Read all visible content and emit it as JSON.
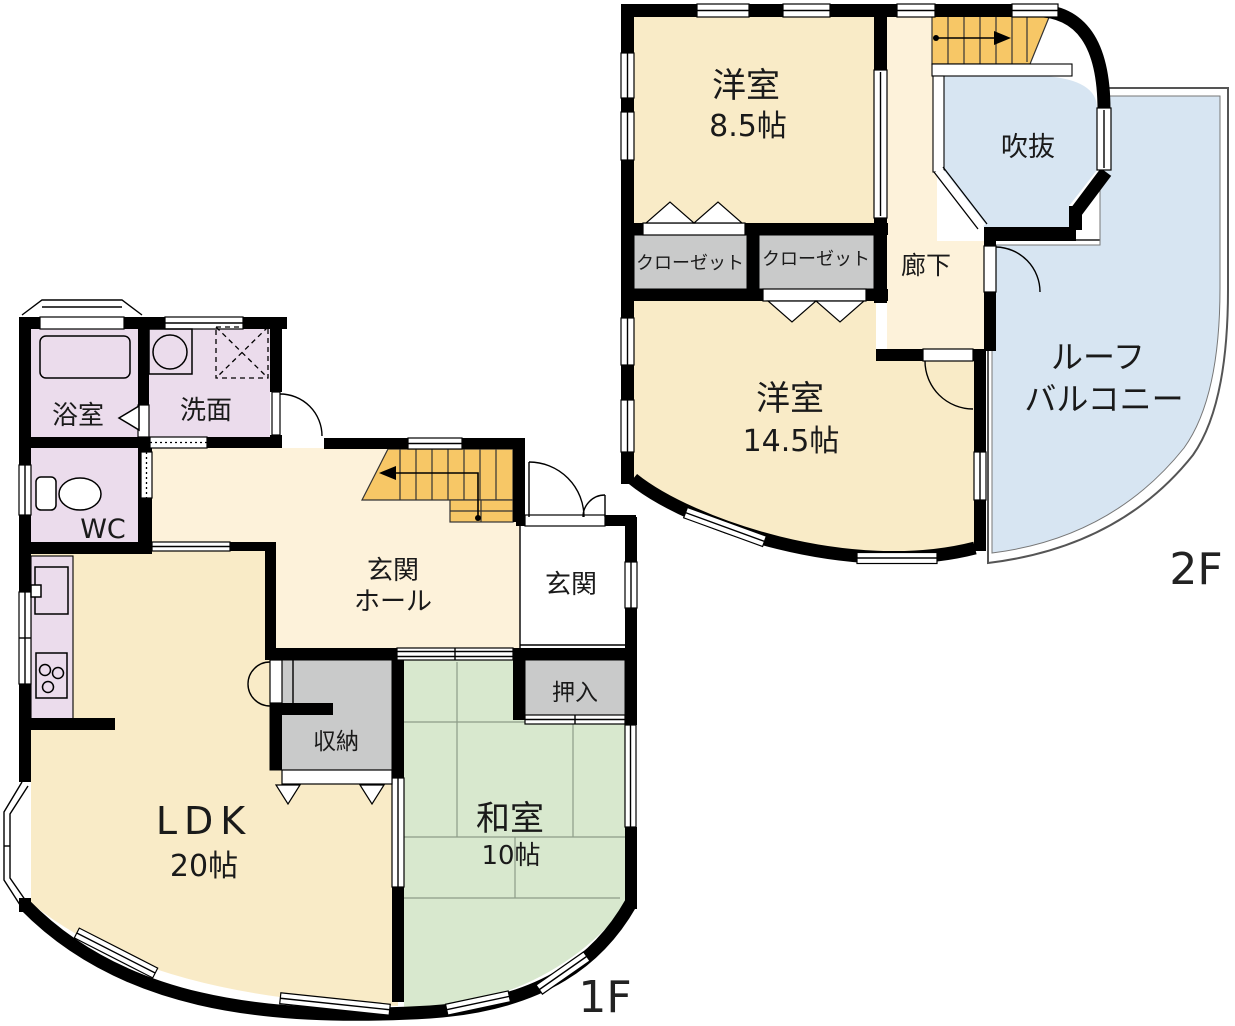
{
  "title": "2-story house floor plan",
  "colors": {
    "room_cream": "#F9EBC7",
    "hall_cream": "#FDF2DA",
    "tatami_green": "#D8E8CE",
    "storage_gray": "#C9CACA",
    "wet_lavender": "#EBDCEC",
    "stairs_orange": "#F7C766",
    "sky_blue": "#D7E5F2",
    "wall_black": "#000000",
    "paper_white": "#FFFFFF"
  },
  "floor2": {
    "label": "2F",
    "room_85": {
      "name": "洋室",
      "size": "8.5帖"
    },
    "closet_left": "クローゼット",
    "closet_right": "クローゼット",
    "hallway": "廊下",
    "void": "吹抜",
    "room_145": {
      "name": "洋室",
      "size": "14.5帖"
    },
    "roof_balcony": {
      "line1": "ルーフ",
      "line2": "バルコニー"
    }
  },
  "floor1": {
    "label": "1F",
    "bathroom": "浴室",
    "washroom": "洗面",
    "toilet": "WC",
    "entrance_hall": {
      "line1": "玄関",
      "line2": "ホール"
    },
    "entrance": "玄関",
    "oshiire": "押入",
    "storage": "収納",
    "ldk": {
      "name": "LDK",
      "size": "20帖"
    },
    "washitsu": {
      "name": "和室",
      "size": "10帖"
    }
  }
}
